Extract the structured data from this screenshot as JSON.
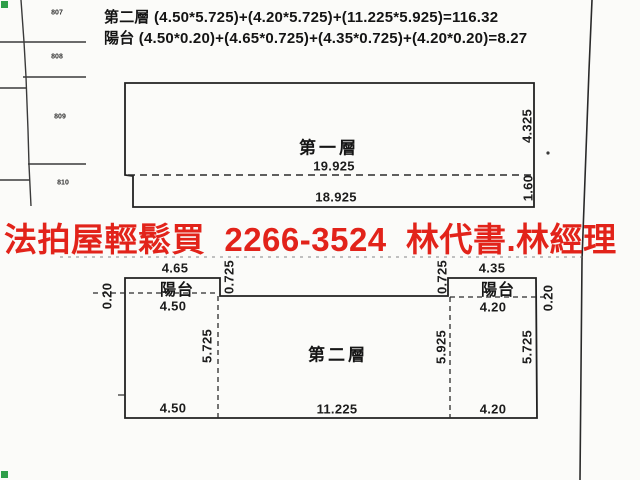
{
  "document": {
    "kind": "scanned floor plan survey sheet"
  },
  "formulas": {
    "second_floor_area": "第二層 (4.50*5.725)+(4.20*5.725)+(11.225*5.925)=116.32",
    "balcony_area": "陽台 (4.50*0.20)+(4.65*0.725)+(4.35*0.725)+(4.20*0.20)=8.27"
  },
  "watermark": {
    "text": "法拍屋輕鬆買  2266-3524  林代書.林經理",
    "color": "#e2231a"
  },
  "cadastral": {
    "parcels": [
      "807",
      "808",
      "809",
      "810"
    ]
  },
  "floor1": {
    "name": "第一層",
    "width_top": "19.925",
    "width_bottom": "18.925",
    "depth_right": "4.325",
    "depth_bottom_right": "1.60"
  },
  "floor2": {
    "name": "第二層",
    "balcony_left": {
      "label": "陽台",
      "width_top": "4.65",
      "width_bottom": "4.50",
      "depth_side": "0.725",
      "depth_end": "0.20"
    },
    "balcony_right": {
      "label": "陽台",
      "width_top": "4.35",
      "width_bottom": "4.20",
      "depth_side": "0.725",
      "depth_end": "0.20"
    },
    "depth_left": "5.725",
    "depth_mid": "5.925",
    "depth_right": "5.725",
    "width_bottom_left": "4.50",
    "width_bottom_mid": "11.225",
    "width_bottom_right": "4.20"
  },
  "corner_marks": {
    "color": "#2f9e49"
  }
}
